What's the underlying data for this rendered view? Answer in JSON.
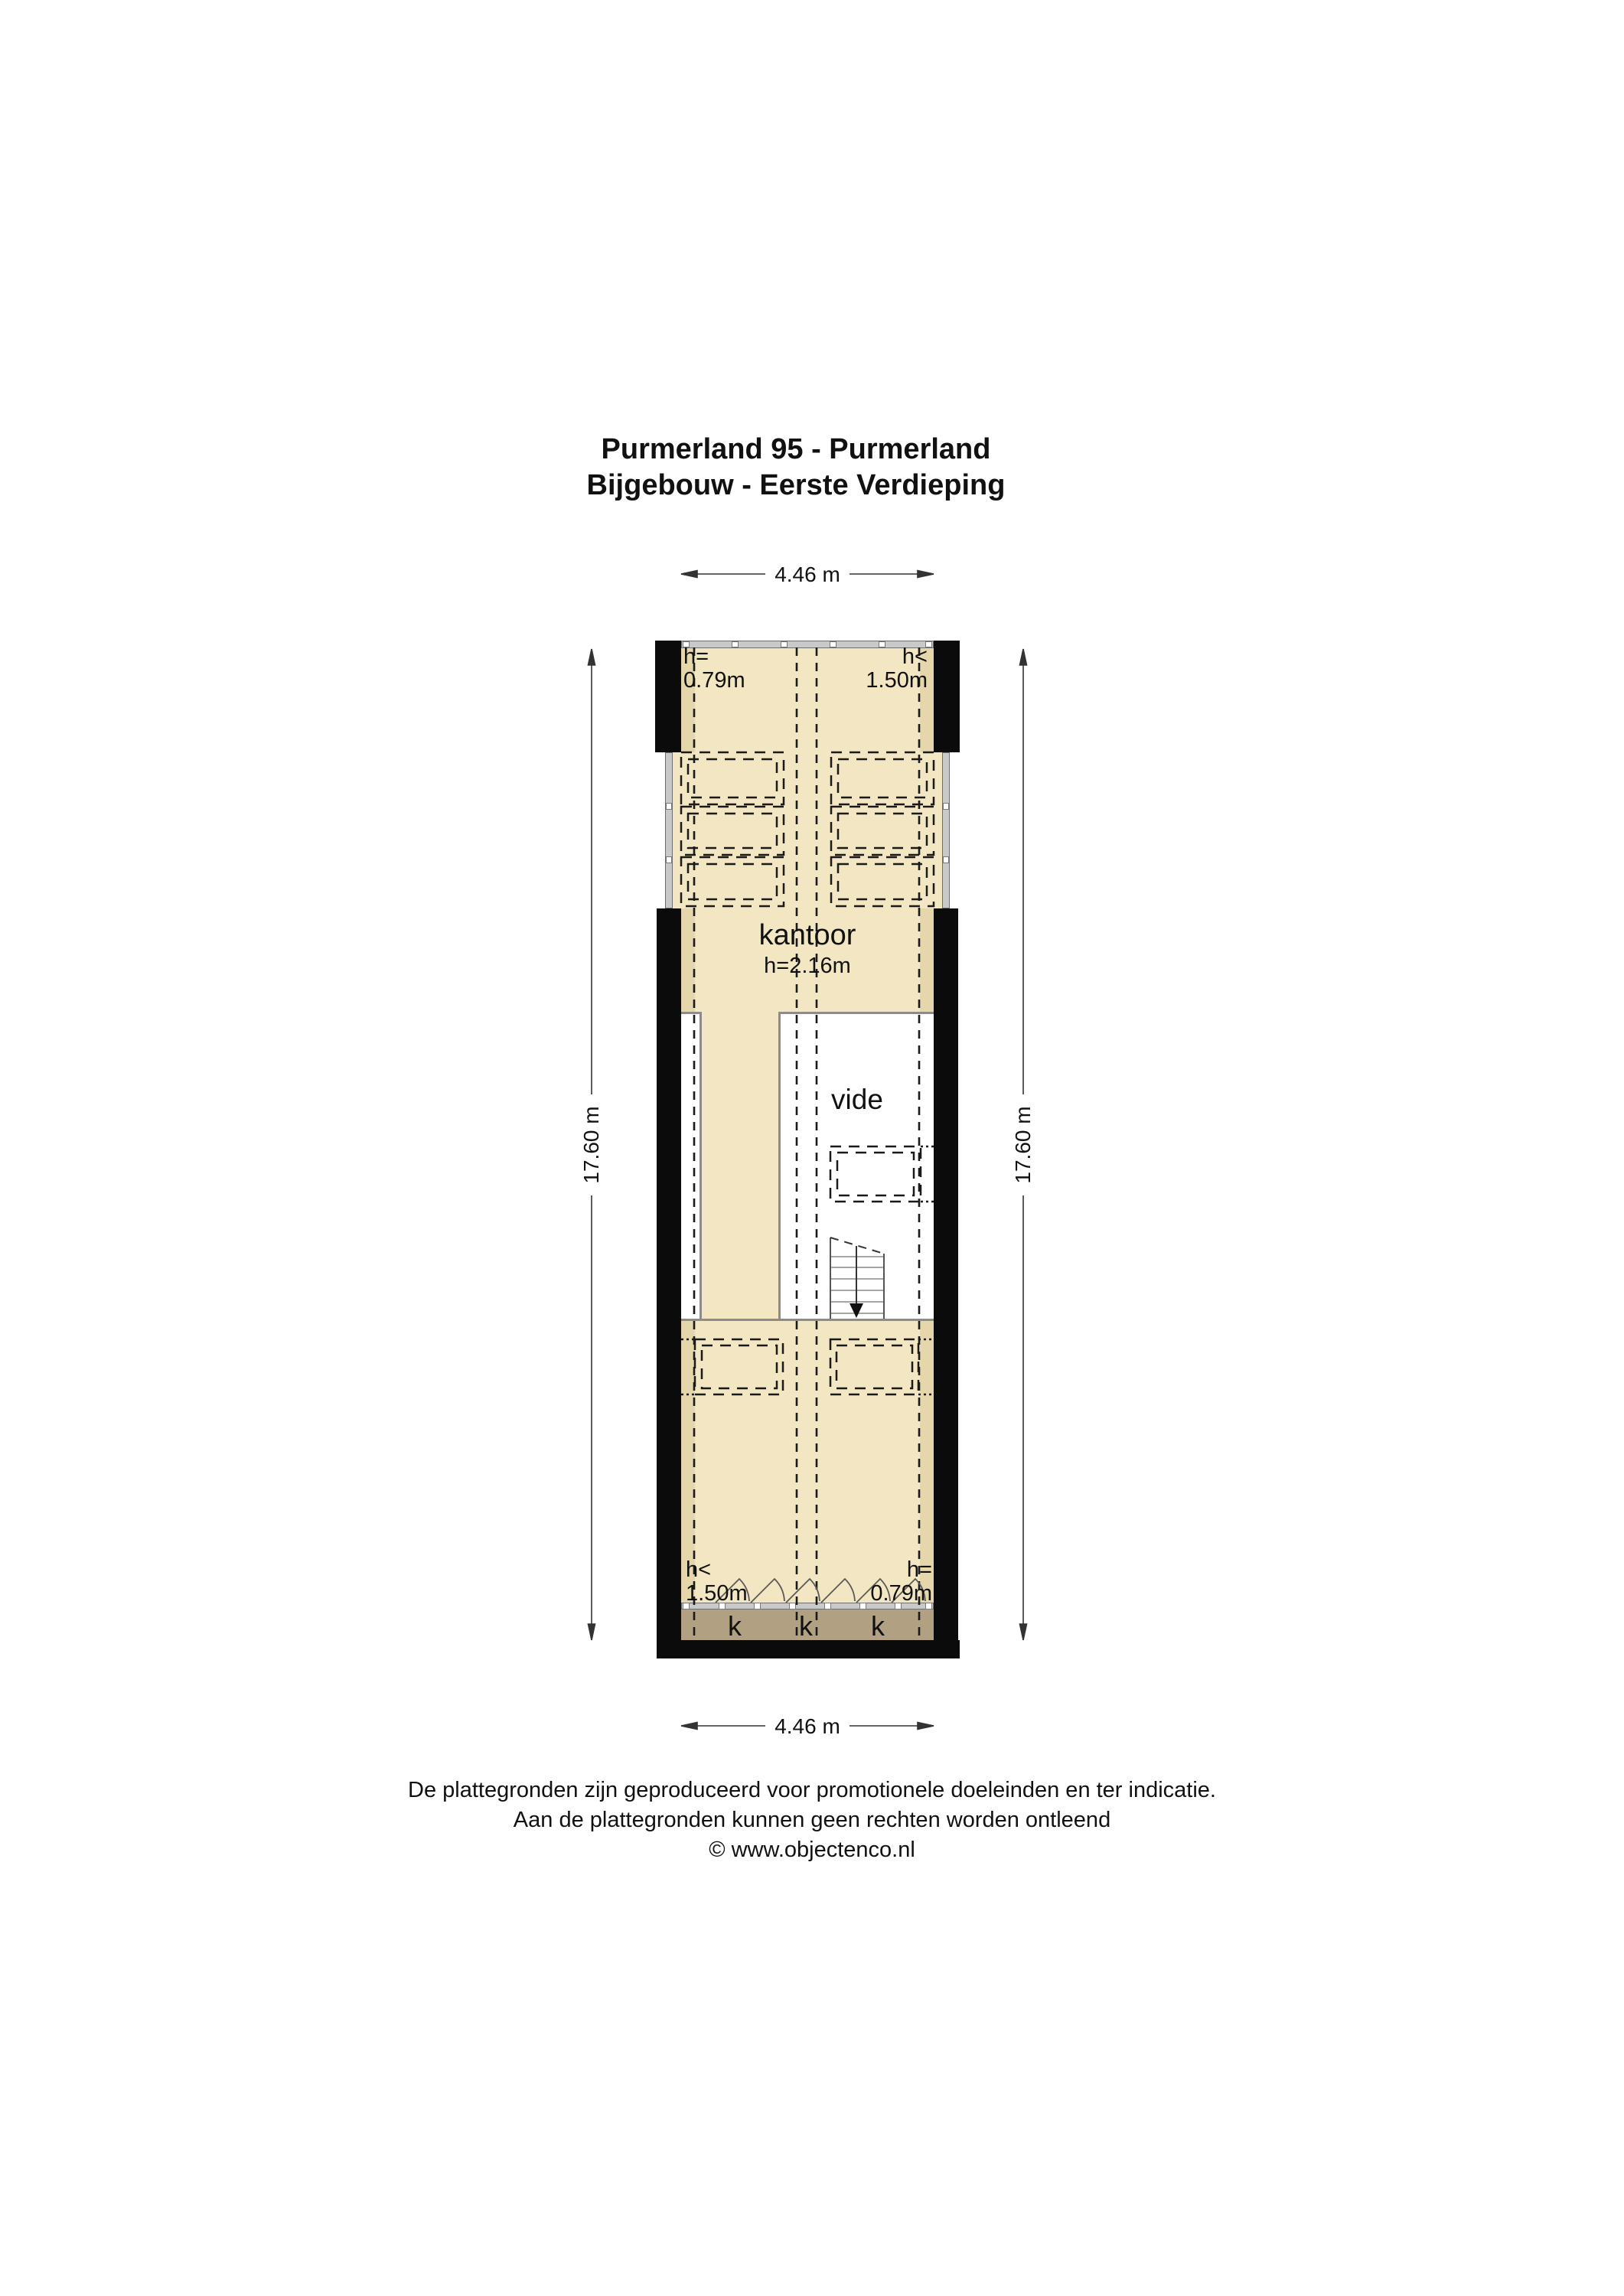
{
  "title": {
    "line1": "Purmerland 95 - Purmerland",
    "line2": "Bijgebouw - Eerste Verdieping"
  },
  "dimensions": {
    "width_top": "4.46 m",
    "width_bottom": "4.46 m",
    "height_left": "17.60 m",
    "height_right": "17.60 m"
  },
  "rooms": {
    "kantoor": {
      "name": "kantoor",
      "height": "h=2.16m"
    },
    "vide": {
      "name": "vide"
    }
  },
  "height_annotations": {
    "top_left": "h=\n0.79m",
    "top_right": "h<\n1.50m",
    "bottom_left": "h<\n1.50m",
    "bottom_right": "h=\n0.79m"
  },
  "closets": {
    "labels": [
      "k",
      "k",
      "k"
    ]
  },
  "footer": {
    "line1": "De plattegronden zijn geproduceerd voor promotionele doeleinden en ter indicatie.",
    "line2": "Aan de plattegronden kunnen geen rechten worden ontleend",
    "line3": "© www.objectenco.nl"
  },
  "colors": {
    "floor": "#f2e6c3",
    "floor-dark": "#e5d6ac",
    "closet": "#b1a081",
    "wallgray": "#c9c9c9",
    "linegray": "#8c8c8c",
    "ink": "#1a1a1a"
  }
}
